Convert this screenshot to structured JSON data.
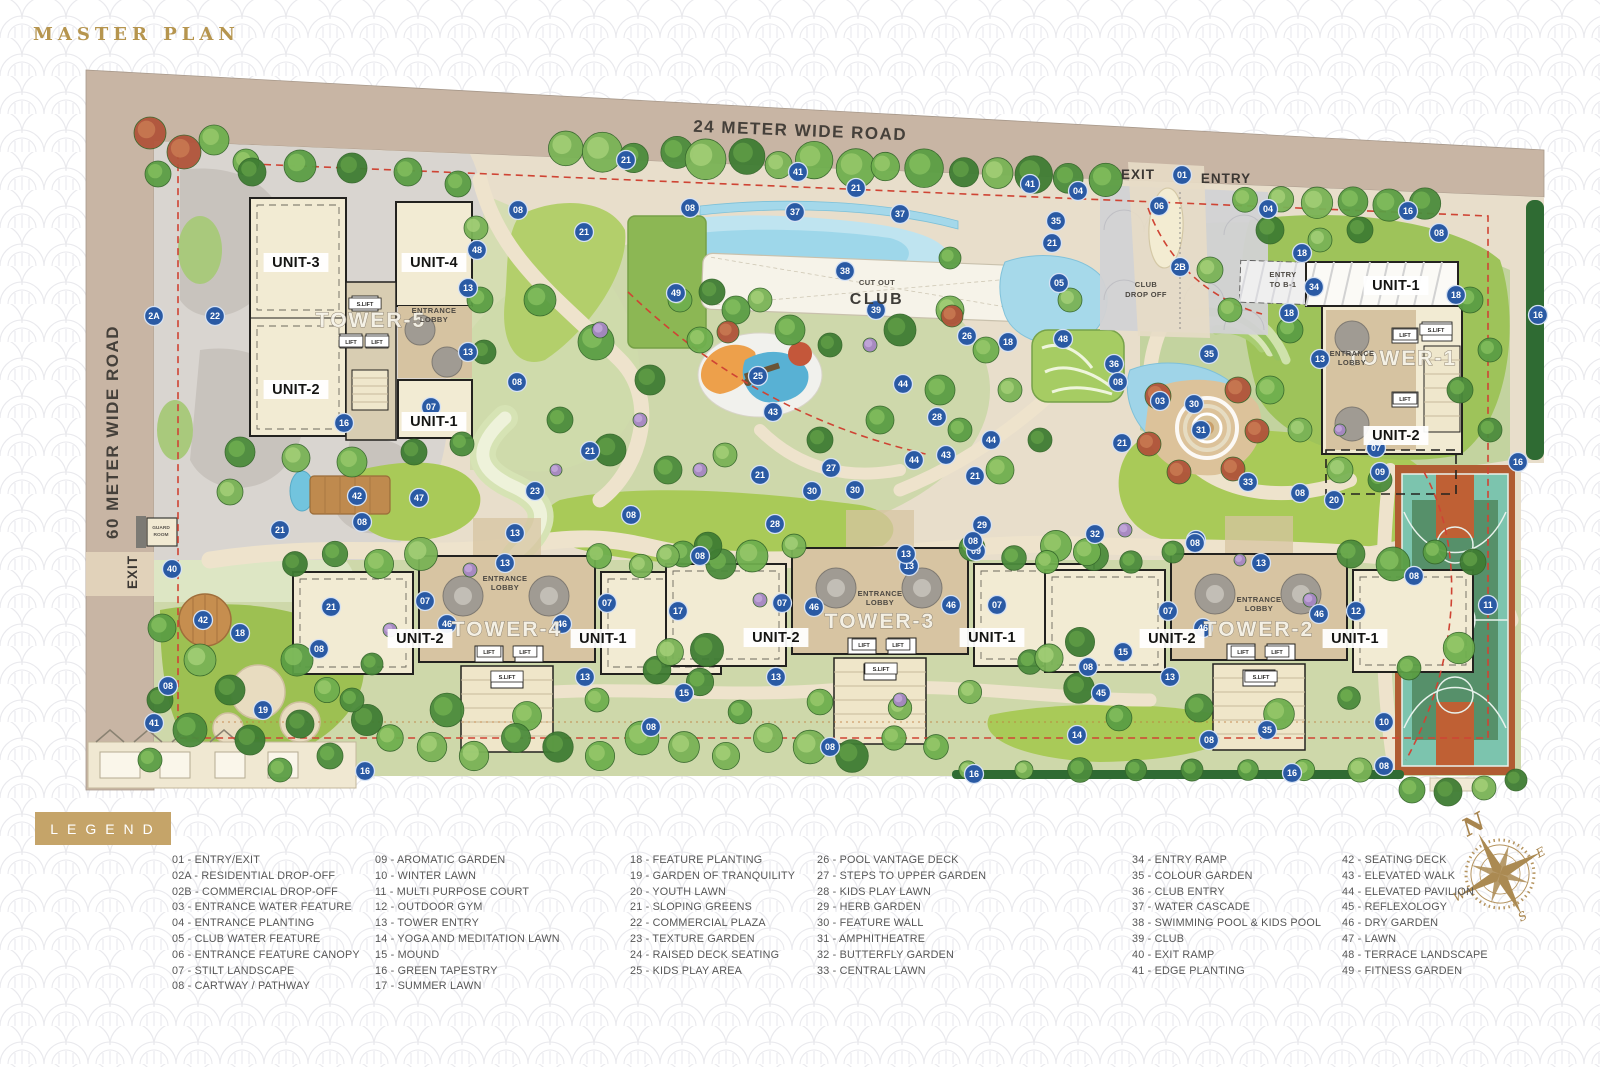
{
  "title": "MASTER PLAN",
  "legend": {
    "title": "LEGEND",
    "columns": [
      [
        {
          "code": "01",
          "label": "ENTRY/EXIT"
        },
        {
          "code": "02A",
          "label": "RESIDENTIAL DROP-OFF"
        },
        {
          "code": "02B",
          "label": "COMMERCIAL DROP-OFF"
        },
        {
          "code": "03",
          "label": "ENTRANCE WATER FEATURE"
        },
        {
          "code": "04",
          "label": "ENTRANCE PLANTING"
        },
        {
          "code": "05",
          "label": "CLUB WATER FEATURE"
        },
        {
          "code": "06",
          "label": "ENTRANCE FEATURE CANOPY"
        },
        {
          "code": "07",
          "label": "STILT LANDSCAPE"
        },
        {
          "code": "08",
          "label": "CARTWAY / PATHWAY"
        }
      ],
      [
        {
          "code": "09",
          "label": "AROMATIC GARDEN"
        },
        {
          "code": "10",
          "label": "WINTER LAWN"
        },
        {
          "code": "11",
          "label": "MULTI PURPOSE COURT"
        },
        {
          "code": "12",
          "label": "OUTDOOR GYM"
        },
        {
          "code": "13",
          "label": "TOWER ENTRY"
        },
        {
          "code": "14",
          "label": "YOGA AND MEDITATION LAWN"
        },
        {
          "code": "15",
          "label": "MOUND"
        },
        {
          "code": "16",
          "label": "GREEN TAPESTRY"
        },
        {
          "code": "17",
          "label": "SUMMER LAWN"
        }
      ],
      [
        {
          "code": "18",
          "label": "FEATURE PLANTING"
        },
        {
          "code": "19",
          "label": "GARDEN OF TRANQUILITY"
        },
        {
          "code": "20",
          "label": "YOUTH LAWN"
        },
        {
          "code": "21",
          "label": "SLOPING GREENS"
        },
        {
          "code": "22",
          "label": "COMMERCIAL PLAZA"
        },
        {
          "code": "23",
          "label": "TEXTURE GARDEN"
        },
        {
          "code": "24",
          "label": "RAISED DECK SEATING"
        },
        {
          "code": "25",
          "label": "KIDS PLAY AREA"
        }
      ],
      [
        {
          "code": "26",
          "label": "POOL VANTAGE DECK"
        },
        {
          "code": "27",
          "label": "STEPS TO UPPER GARDEN"
        },
        {
          "code": "28",
          "label": "KIDS PLAY LAWN"
        },
        {
          "code": "29",
          "label": "HERB GARDEN"
        },
        {
          "code": "30",
          "label": "FEATURE WALL"
        },
        {
          "code": "31",
          "label": "AMPHITHEATRE"
        },
        {
          "code": "32",
          "label": "BUTTERFLY GARDEN"
        },
        {
          "code": "33",
          "label": "CENTRAL LAWN"
        }
      ],
      [
        {
          "code": "34",
          "label": "ENTRY RAMP"
        },
        {
          "code": "35",
          "label": "COLOUR GARDEN"
        },
        {
          "code": "36",
          "label": "CLUB ENTRY"
        },
        {
          "code": "37",
          "label": "WATER CASCADE"
        },
        {
          "code": "38",
          "label": "SWIMMING POOL & KIDS POOL"
        },
        {
          "code": "39",
          "label": "CLUB"
        },
        {
          "code": "40",
          "label": "EXIT RAMP"
        },
        {
          "code": "41",
          "label": "EDGE PLANTING"
        }
      ],
      [
        {
          "code": "42",
          "label": "SEATING DECK"
        },
        {
          "code": "43",
          "label": "ELEVATED WALK"
        },
        {
          "code": "44",
          "label": "ELEVATED PAVILION"
        },
        {
          "code": "45",
          "label": "REFLEXOLOGY"
        },
        {
          "code": "46",
          "label": "DRY GARDEN"
        },
        {
          "code": "47",
          "label": "LAWN"
        },
        {
          "code": "48",
          "label": "TERRACE LANDSCAPE"
        },
        {
          "code": "49",
          "label": "FITNESS GARDEN"
        }
      ]
    ]
  },
  "compass": {
    "n": "N",
    "e": "E",
    "s": "S",
    "w": "W"
  },
  "colors": {
    "road": "#c8b5a4",
    "marker": "#2a5aa4",
    "gold": "#c5a469",
    "red_dash": "#cf4434",
    "water": "#a6d9ea",
    "lawn": "#a9ca58",
    "court_teal": "#7cc4ae",
    "court_orange": "#bf6034",
    "building": "#f2ebd3",
    "core_tan": "#d7c4a2"
  },
  "plan": {
    "markers": [
      [
        "21",
        626,
        160
      ],
      [
        "08",
        690,
        208
      ],
      [
        "41",
        798,
        172
      ],
      [
        "21",
        856,
        188
      ],
      [
        "37",
        795,
        212
      ],
      [
        "37",
        900,
        214
      ],
      [
        "41",
        1030,
        184
      ],
      [
        "04",
        1078,
        191
      ],
      [
        "35",
        1056,
        221
      ],
      [
        "21",
        1052,
        243
      ],
      [
        "06",
        1159,
        206
      ],
      [
        "01",
        1182,
        175
      ],
      [
        "2B",
        1180,
        267
      ],
      [
        "04",
        1268,
        209
      ],
      [
        "16",
        1408,
        211
      ],
      [
        "18",
        1302,
        253
      ],
      [
        "34",
        1314,
        287
      ],
      [
        "18",
        1289,
        313
      ],
      [
        "08",
        1439,
        233
      ],
      [
        "18",
        1456,
        295
      ],
      [
        "16",
        1538,
        315
      ],
      [
        "13",
        1320,
        359
      ],
      [
        "07",
        1376,
        448
      ],
      [
        "09",
        1380,
        472
      ],
      [
        "16",
        1518,
        462
      ],
      [
        "08",
        518,
        210
      ],
      [
        "21",
        584,
        232
      ],
      [
        "48",
        477,
        250
      ],
      [
        "13",
        468,
        288
      ],
      [
        "13",
        468,
        352
      ],
      [
        "08",
        517,
        382
      ],
      [
        "07",
        431,
        407
      ],
      [
        "16",
        344,
        423
      ],
      [
        "2A",
        154,
        316
      ],
      [
        "22",
        215,
        316
      ],
      [
        "49",
        676,
        293
      ],
      [
        "38",
        845,
        271
      ],
      [
        "39",
        876,
        310
      ],
      [
        "05",
        1059,
        283
      ],
      [
        "26",
        967,
        336
      ],
      [
        "18",
        1008,
        342
      ],
      [
        "48",
        1063,
        339
      ],
      [
        "36",
        1114,
        364
      ],
      [
        "08",
        1118,
        382
      ],
      [
        "25",
        758,
        376
      ],
      [
        "43",
        773,
        412
      ],
      [
        "44",
        903,
        384
      ],
      [
        "28",
        937,
        417
      ],
      [
        "27",
        831,
        468
      ],
      [
        "21",
        760,
        475
      ],
      [
        "44",
        914,
        460
      ],
      [
        "43",
        946,
        455
      ],
      [
        "44",
        991,
        440
      ],
      [
        "21",
        975,
        476
      ],
      [
        "29",
        982,
        525
      ],
      [
        "09",
        976,
        551
      ],
      [
        "35",
        1209,
        354
      ],
      [
        "03",
        1160,
        401
      ],
      [
        "30",
        1194,
        404
      ],
      [
        "31",
        1201,
        430
      ],
      [
        "21",
        1122,
        443
      ],
      [
        "33",
        1248,
        482
      ],
      [
        "08",
        1300,
        493
      ],
      [
        "20",
        1334,
        500
      ],
      [
        "32",
        1095,
        534
      ],
      [
        "08",
        1196,
        540
      ],
      [
        "21",
        590,
        451
      ],
      [
        "23",
        535,
        491
      ],
      [
        "13",
        515,
        533
      ],
      [
        "08",
        631,
        515
      ],
      [
        "30",
        812,
        491
      ],
      [
        "30",
        855,
        490
      ],
      [
        "28",
        775,
        524
      ],
      [
        "08",
        700,
        556
      ],
      [
        "13",
        909,
        566
      ],
      [
        "17",
        678,
        611
      ],
      [
        "42",
        357,
        496
      ],
      [
        "47",
        419,
        498
      ],
      [
        "08",
        362,
        522
      ],
      [
        "21",
        280,
        530
      ],
      [
        "40",
        172,
        569
      ],
      [
        "42",
        203,
        620
      ],
      [
        "18",
        240,
        633
      ],
      [
        "21",
        331,
        607
      ],
      [
        "08",
        319,
        649
      ],
      [
        "08",
        168,
        686
      ],
      [
        "41",
        154,
        723
      ],
      [
        "19",
        263,
        710
      ],
      [
        "16",
        365,
        771
      ],
      [
        "13",
        505,
        563
      ],
      [
        "07",
        425,
        601
      ],
      [
        "07",
        607,
        603
      ],
      [
        "46",
        447,
        624
      ],
      [
        "46",
        562,
        624
      ],
      [
        "13",
        585,
        677
      ],
      [
        "15",
        684,
        693
      ],
      [
        "08",
        651,
        727
      ],
      [
        "08",
        973,
        541
      ],
      [
        "13",
        906,
        554
      ],
      [
        "07",
        782,
        603
      ],
      [
        "46",
        814,
        607
      ],
      [
        "46",
        951,
        605
      ],
      [
        "07",
        997,
        605
      ],
      [
        "13",
        776,
        677
      ],
      [
        "08",
        1195,
        543
      ],
      [
        "13",
        1261,
        563
      ],
      [
        "07",
        1168,
        611
      ],
      [
        "46",
        1203,
        628
      ],
      [
        "46",
        1319,
        614
      ],
      [
        "12",
        1356,
        611
      ],
      [
        "15",
        1123,
        652
      ],
      [
        "08",
        1088,
        667
      ],
      [
        "13",
        1170,
        677
      ],
      [
        "45",
        1101,
        693
      ],
      [
        "10",
        1384,
        722
      ],
      [
        "35",
        1267,
        730
      ],
      [
        "14",
        1077,
        735
      ],
      [
        "08",
        1209,
        740
      ],
      [
        "16",
        974,
        774
      ],
      [
        "16",
        1292,
        773
      ],
      [
        "08",
        1384,
        766
      ],
      [
        "08",
        1414,
        576
      ],
      [
        "11",
        1488,
        605
      ],
      [
        "08",
        830,
        747
      ]
    ],
    "labels": [
      {
        "t": "24 METER WIDE ROAD",
        "x": 800,
        "y": 136,
        "c": "road",
        "r": 2.3
      },
      {
        "t": "60  METER WIDE ROAD",
        "x": 118,
        "y": 432,
        "c": "road",
        "r": -90
      },
      {
        "t": "EXIT",
        "x": 1138,
        "y": 179,
        "c": "gate"
      },
      {
        "t": "ENTRY",
        "x": 1226,
        "y": 183,
        "c": "gate"
      },
      {
        "t": "EXIT",
        "x": 137,
        "y": 572,
        "c": "gate",
        "r": -90
      },
      {
        "t": "CLUB",
        "x": 1146,
        "y": 287,
        "c": "tiny"
      },
      {
        "t": "DROP OFF",
        "x": 1146,
        "y": 297,
        "c": "tiny"
      },
      {
        "t": "ENTRY",
        "x": 1283,
        "y": 277,
        "c": "tiny"
      },
      {
        "t": "TO B-1",
        "x": 1283,
        "y": 287,
        "c": "tiny"
      },
      {
        "t": "GUARD",
        "x": 161,
        "y": 529,
        "c": "tiny3"
      },
      {
        "t": "ROOM",
        "x": 161,
        "y": 536,
        "c": "tiny3"
      },
      {
        "t": "CUT OUT",
        "x": 877,
        "y": 285,
        "c": "tiny"
      },
      {
        "t": "CLUB",
        "x": 877,
        "y": 304,
        "c": "clubname"
      },
      {
        "t": "UNIT-3",
        "x": 296,
        "y": 267,
        "c": "unit"
      },
      {
        "t": "UNIT-4",
        "x": 434,
        "y": 267,
        "c": "unit"
      },
      {
        "t": "UNIT-2",
        "x": 296,
        "y": 394,
        "c": "unit"
      },
      {
        "t": "UNIT-1",
        "x": 434,
        "y": 426,
        "c": "unit"
      },
      {
        "t": "TOWER-5",
        "x": 371,
        "y": 327,
        "c": "tower"
      },
      {
        "t": "ENTRANCE",
        "x": 434,
        "y": 313,
        "c": "tiny"
      },
      {
        "t": "LOBBY",
        "x": 434,
        "y": 322,
        "c": "tiny"
      },
      {
        "t": "S.LIFT",
        "x": 365,
        "y": 306,
        "c": "lift"
      },
      {
        "t": "LIFT",
        "x": 351,
        "y": 344,
        "c": "lift"
      },
      {
        "t": "LIFT",
        "x": 377,
        "y": 344,
        "c": "lift"
      },
      {
        "t": "UNIT-1",
        "x": 1396,
        "y": 290,
        "c": "unit"
      },
      {
        "t": "UNIT-2",
        "x": 1396,
        "y": 440,
        "c": "unit"
      },
      {
        "t": "TOWER-1",
        "x": 1402,
        "y": 365,
        "c": "tower"
      },
      {
        "t": "ENTRANCE",
        "x": 1352,
        "y": 356,
        "c": "tiny"
      },
      {
        "t": "LOBBY",
        "x": 1352,
        "y": 365,
        "c": "tiny"
      },
      {
        "t": "LIFT",
        "x": 1405,
        "y": 337,
        "c": "lift"
      },
      {
        "t": "S.LIFT",
        "x": 1436,
        "y": 332,
        "c": "lift"
      },
      {
        "t": "LIFT",
        "x": 1405,
        "y": 401,
        "c": "lift"
      },
      {
        "t": "UNIT-2",
        "x": 420,
        "y": 643,
        "c": "unit"
      },
      {
        "t": "UNIT-1",
        "x": 603,
        "y": 643,
        "c": "unit"
      },
      {
        "t": "TOWER-4",
        "x": 507,
        "y": 636,
        "c": "tower"
      },
      {
        "t": "ENTRANCE",
        "x": 505,
        "y": 581,
        "c": "tiny"
      },
      {
        "t": "LOBBY",
        "x": 505,
        "y": 590,
        "c": "tiny"
      },
      {
        "t": "LIFT",
        "x": 489,
        "y": 654,
        "c": "lift"
      },
      {
        "t": "LIFT",
        "x": 525,
        "y": 654,
        "c": "lift"
      },
      {
        "t": "S.LIFT",
        "x": 507,
        "y": 679,
        "c": "lift"
      },
      {
        "t": "UNIT-2",
        "x": 776,
        "y": 642,
        "c": "unit"
      },
      {
        "t": "UNIT-1",
        "x": 992,
        "y": 642,
        "c": "unit"
      },
      {
        "t": "TOWER-3",
        "x": 880,
        "y": 628,
        "c": "tower"
      },
      {
        "t": "ENTRANCE",
        "x": 880,
        "y": 596,
        "c": "tiny"
      },
      {
        "t": "LOBBY",
        "x": 880,
        "y": 605,
        "c": "tiny"
      },
      {
        "t": "LIFT",
        "x": 864,
        "y": 647,
        "c": "lift"
      },
      {
        "t": "LIFT",
        "x": 898,
        "y": 647,
        "c": "lift"
      },
      {
        "t": "S.LIFT",
        "x": 881,
        "y": 671,
        "c": "lift"
      },
      {
        "t": "UNIT-2",
        "x": 1172,
        "y": 643,
        "c": "unit"
      },
      {
        "t": "UNIT-1",
        "x": 1355,
        "y": 643,
        "c": "unit"
      },
      {
        "t": "TOWER-2",
        "x": 1259,
        "y": 636,
        "c": "tower"
      },
      {
        "t": "ENTRANCE",
        "x": 1259,
        "y": 602,
        "c": "tiny"
      },
      {
        "t": "LOBBY",
        "x": 1259,
        "y": 611,
        "c": "tiny"
      },
      {
        "t": "LIFT",
        "x": 1243,
        "y": 654,
        "c": "lift"
      },
      {
        "t": "LIFT",
        "x": 1277,
        "y": 654,
        "c": "lift"
      },
      {
        "t": "S.LIFT",
        "x": 1261,
        "y": 679,
        "c": "lift"
      }
    ]
  }
}
